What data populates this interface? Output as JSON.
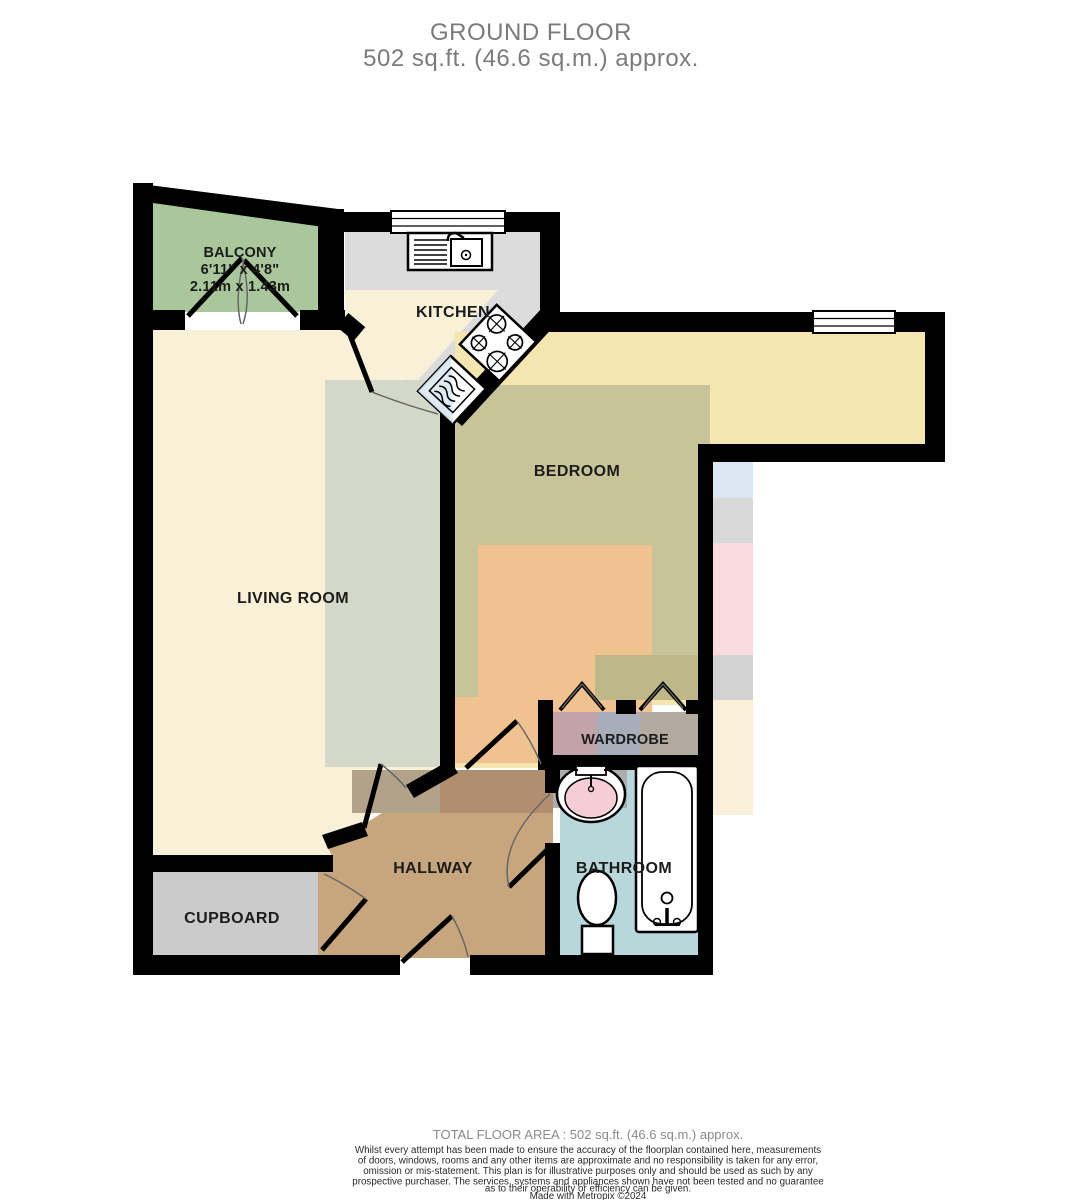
{
  "title": {
    "line1": "GROUND FLOOR",
    "line2": "502 sq.ft. (46.6 sq.m.) approx."
  },
  "rooms": {
    "balcony": {
      "label": "BALCONY",
      "dim_imperial": "6'11\" x 4'8\"",
      "dim_metric": "2.11m x 1.43m"
    },
    "kitchen": {
      "label": "KITCHEN"
    },
    "bedroom": {
      "label": "BEDROOM"
    },
    "living": {
      "label": "LIVING ROOM"
    },
    "wardrobe": {
      "label": "WARDROBE"
    },
    "hallway": {
      "label": "HALLWAY"
    },
    "bathroom": {
      "label": "BATHROOM"
    },
    "cupboard": {
      "label": "CUPBOARD"
    }
  },
  "footer": {
    "total_area": "TOTAL FLOOR AREA : 502 sq.ft. (46.6 sq.m.) approx.",
    "disclaimer_lines": [
      "Whilst every attempt has been made to ensure the accuracy of the floorplan contained here, measurements",
      "of doors, windows, rooms and any other items are approximate and no responsibility is taken for any error,",
      "omission or mis-statement. This plan is for illustrative purposes only and should be used as such by any",
      "prospective purchaser. The services, systems and appliances shown have not been tested and no guarantee",
      "as to their operability or efficiency can be given."
    ],
    "credit": "Made with Metropix ©2024"
  },
  "colors": {
    "wall": "#000000",
    "balcony_floor": "#a9c79b",
    "kitchen_floor": "#f8f1d8",
    "counter_gray": "#dcdcdc",
    "living_floor": "#f8f1d8",
    "living_overlay": "#d4d8c8",
    "bedroom_floor": "#f5e5ae",
    "bedroom_olive": "#c8c499",
    "bedroom_olive_dark": "#beb888",
    "bedroom_orange": "#efc28f",
    "hallway_floor": "#c8a67d",
    "hallway_shadow_a": "#b3a28a",
    "hallway_shadow_b": "#b18e70",
    "cupboard_floor": "#cbcbcb",
    "bathroom_floor": "#b7d7db",
    "bathroom_counter": "#aeacac",
    "bathroom_cream": "#f7edd8",
    "wardrobe_pink": "#c3a2ac",
    "wardrobe_blue": "#a8adbb",
    "wardrobe_gray": "#b2aa9e",
    "sink_pink": "#f6ccd6",
    "appliance_blue": "#dce9f2",
    "bleed_blue": "#dbe7f3",
    "bleed_gray": "#d9d9d9",
    "bleed_pink": "#fadbe0",
    "bleed_gray2": "#d2d2d2",
    "bleed_cream": "#faf0da",
    "title_gray": "#7b7b7b",
    "footer_gray": "#8a8a8a",
    "text_dark": "#1c1c1c"
  }
}
